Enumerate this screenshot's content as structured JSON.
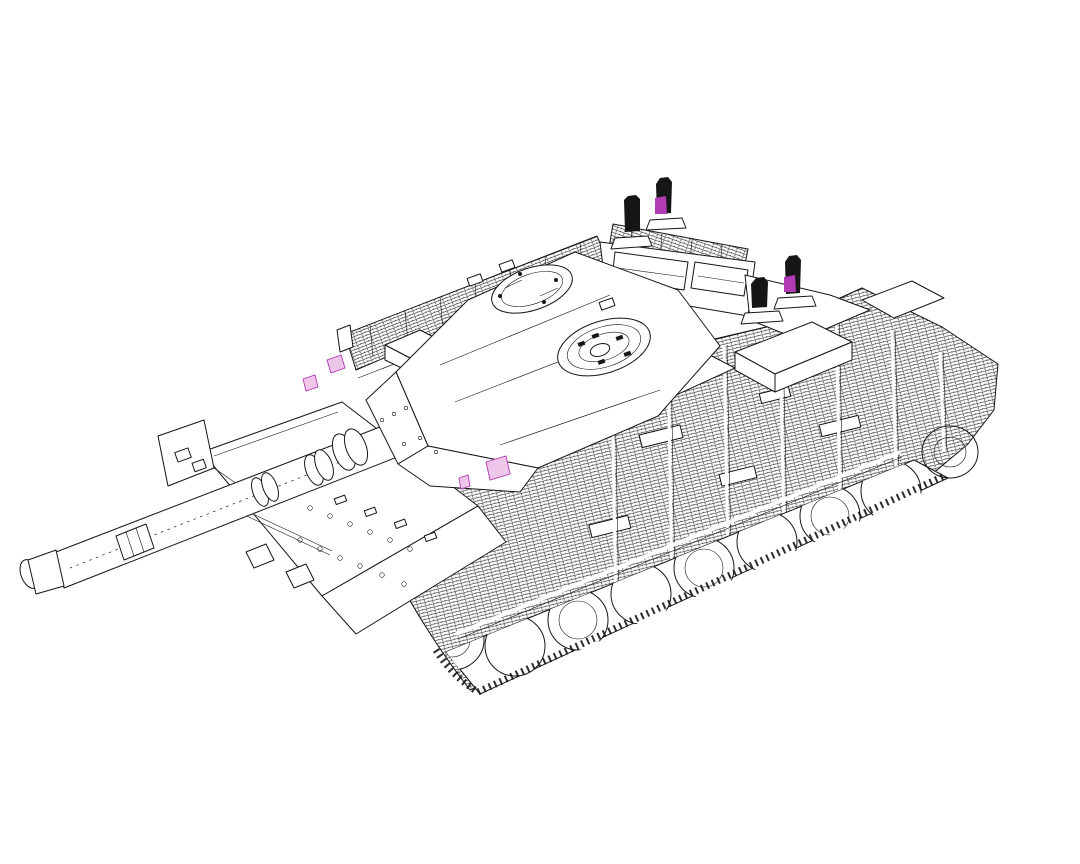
{
  "figure": {
    "description": "Black-and-white isometric CAD line drawing of a main battle tank seen from the front-left: long smoothbore gun with clamp collars pointing to the lower left, angular turret with two round roof hatches, slat-armour panels hatched along the hull sides and rear, road wheels peeking under the side skirts, and four black aerials on the rear deck, two of them with violet-highlighted bases plus small violet-highlighted fittings near the turret front.",
    "colors": {
      "background": "#ffffff",
      "line": "#161616",
      "accent": "#b23ab2",
      "accent_light": "#eec6ea"
    }
  }
}
